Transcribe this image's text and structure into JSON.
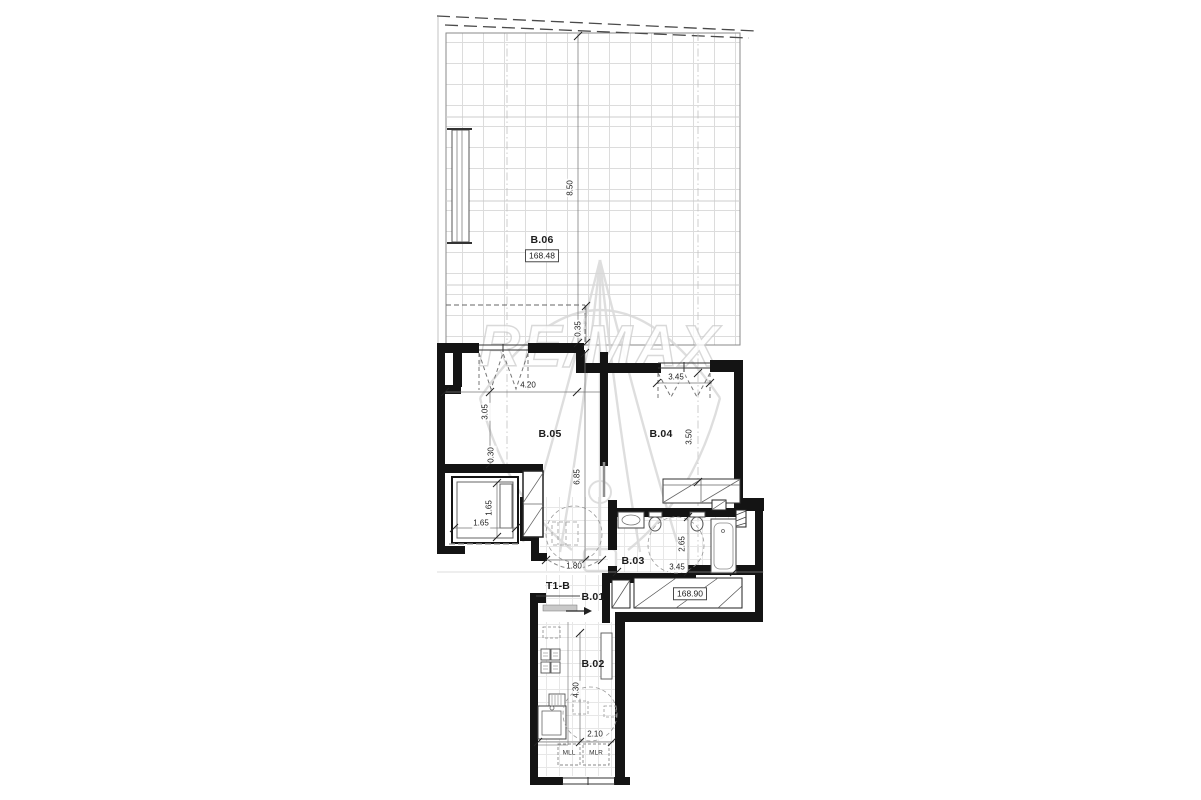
{
  "watermark": {
    "brand": "RE/MAX"
  },
  "unit": {
    "type_label": "T1-B"
  },
  "rooms": {
    "b06": {
      "label": "B.06"
    },
    "b05": {
      "label": "B.05"
    },
    "b04": {
      "label": "B.04"
    },
    "b03": {
      "label": "B.03"
    },
    "b02": {
      "label": "B.02"
    },
    "b01": {
      "label": "B.01"
    }
  },
  "elevations": {
    "terrace": "168.48",
    "entry": "168.90"
  },
  "appliances": {
    "left": "MLL",
    "right": "MLR"
  },
  "dimensions": {
    "terrace_depth": "8.50",
    "skylight_offset": "0.35",
    "living_width": "4.20",
    "bedroom_window": "3.45",
    "living_left_depth": "3.05",
    "wall_step": "0.30",
    "bedroom_depth": "3.50",
    "living_depth": "6.85",
    "elevator_depth": "1.65",
    "elevator_width": "1.65",
    "hall_opening": "1.80",
    "bath_depth": "2.65",
    "bath_width": "3.45",
    "kitchen_length": "4.30",
    "kitchen_width": "2.10"
  }
}
